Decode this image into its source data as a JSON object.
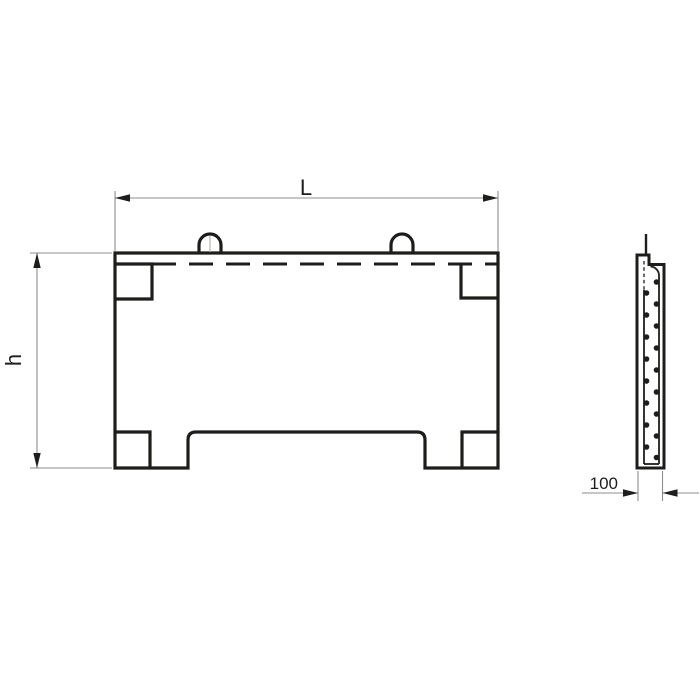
{
  "drawing": {
    "dimensions": {
      "length_label": "L",
      "height_label": "h",
      "thickness_label": "100"
    },
    "colors": {
      "outline": "#1d1d1b",
      "dimension_line": "#8c8c8c",
      "arrow": "#1d1d1b",
      "background": "#ffffff"
    }
  }
}
